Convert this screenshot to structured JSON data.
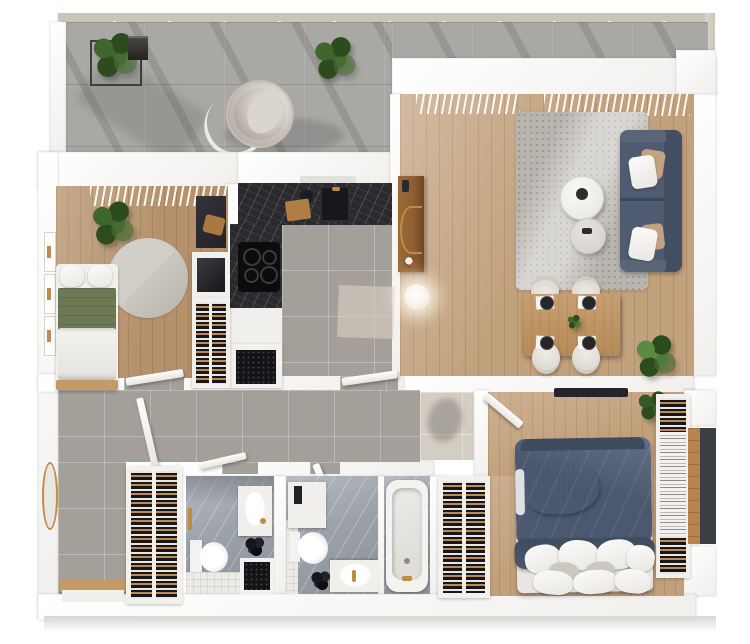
{
  "scene": {
    "kind": "3d-apartment-floor-plan",
    "view": "top-down-render",
    "background": "#ffffff",
    "visible_text": ""
  },
  "palette": {
    "wall": "#f1efec",
    "concrete": "#a9a8a5",
    "railing-beam": "#c9c6b8",
    "wood-living": "#c2a17d",
    "wood-bed2": "#b5926c",
    "wood-master": "#c2a07b",
    "wood-furn": "#c2996a",
    "console-wood": "#8f5e32",
    "tile-gray": "#a59f9a",
    "tile-beige": "#d4cdc2",
    "tile-white": "#edebe7",
    "marble-dark": "#2a292d",
    "marble-bath-light": "#b6bbc2",
    "marble-bath-deep": "#8c929b",
    "sofa": "#4f5b70",
    "sofa-dark": "#434e62",
    "rug-living": "#b8b4ae",
    "rug-round": "#cbc7c1",
    "bed-navy": "#4b5870",
    "bed-green": "#6b7955",
    "pillow-white": "#f2f1ee",
    "throw-gray": "#a7adb5",
    "wardrobe-dark": "#191619",
    "hanger-white": "#e8e6e3",
    "clothes-tan": "#bd8a52",
    "gold": "#c08b45",
    "plant-green": "#3f662c",
    "plant-deep": "#2c4c1d",
    "tv-dark": "#23252b",
    "slab-shadow": "#d8d7d4"
  },
  "rooms": [
    {
      "id": "terrace",
      "floor": "concrete-tiles"
    },
    {
      "id": "living-dining-room",
      "floor": "oak-planks"
    },
    {
      "id": "kitchen",
      "floor": "gray-tiles"
    },
    {
      "id": "bedroom-2",
      "floor": "oak-planks"
    },
    {
      "id": "hallway",
      "floor": "gray-tiles"
    },
    {
      "id": "vestibule",
      "floor": "beige-tiles"
    },
    {
      "id": "walk-in-closet",
      "floor": "hidden"
    },
    {
      "id": "bathroom-1",
      "floor": "marble"
    },
    {
      "id": "bathroom-2",
      "floor": "marble"
    },
    {
      "id": "master-bedroom",
      "floor": "oak-planks"
    }
  ],
  "furniture": {
    "terrace": [
      "glass-railing",
      "wire-planter-plant",
      "lantern",
      "potted-plant",
      "hanging-egg-chair"
    ],
    "living_dining": [
      "window-blinds",
      "area-rug",
      "sofa-with-pillows",
      "round-coffee-table-large",
      "round-coffee-table-small",
      "wood-console",
      "sphere-floor-lamp",
      "dining-table",
      "dining-chairs-x4",
      "place-settings-x4",
      "centerpiece-plant",
      "palm-plant"
    ],
    "kitchen": [
      "dark-marble-counter-L",
      "induction-cooktop",
      "sink",
      "kettle",
      "cutting-board",
      "oven-cabinet",
      "floor-mat"
    ],
    "bedroom_2": [
      "single-bed-green",
      "round-rug",
      "potted-plant",
      "desk",
      "media-console",
      "open-wardrobe"
    ],
    "hallway": [
      "open-doors-x5",
      "round-gold-mirror",
      "entry-bench"
    ],
    "walk_in_closet": [
      "double-clothes-rack"
    ],
    "bathroom_1": [
      "vanity-sink",
      "toilet",
      "shower-tray",
      "tiled-bench",
      "black-plant",
      "towel-bar"
    ],
    "bathroom_2": [
      "vanity-shelf",
      "toilet",
      "sink-counter",
      "bathtub",
      "black-plant"
    ],
    "master_bedroom": [
      "double-bed-navy",
      "throw-blanket",
      "pillows",
      "wardrobe-left",
      "clothes-rack-right",
      "wall-tv",
      "corner-plant",
      "side-niche"
    ]
  }
}
